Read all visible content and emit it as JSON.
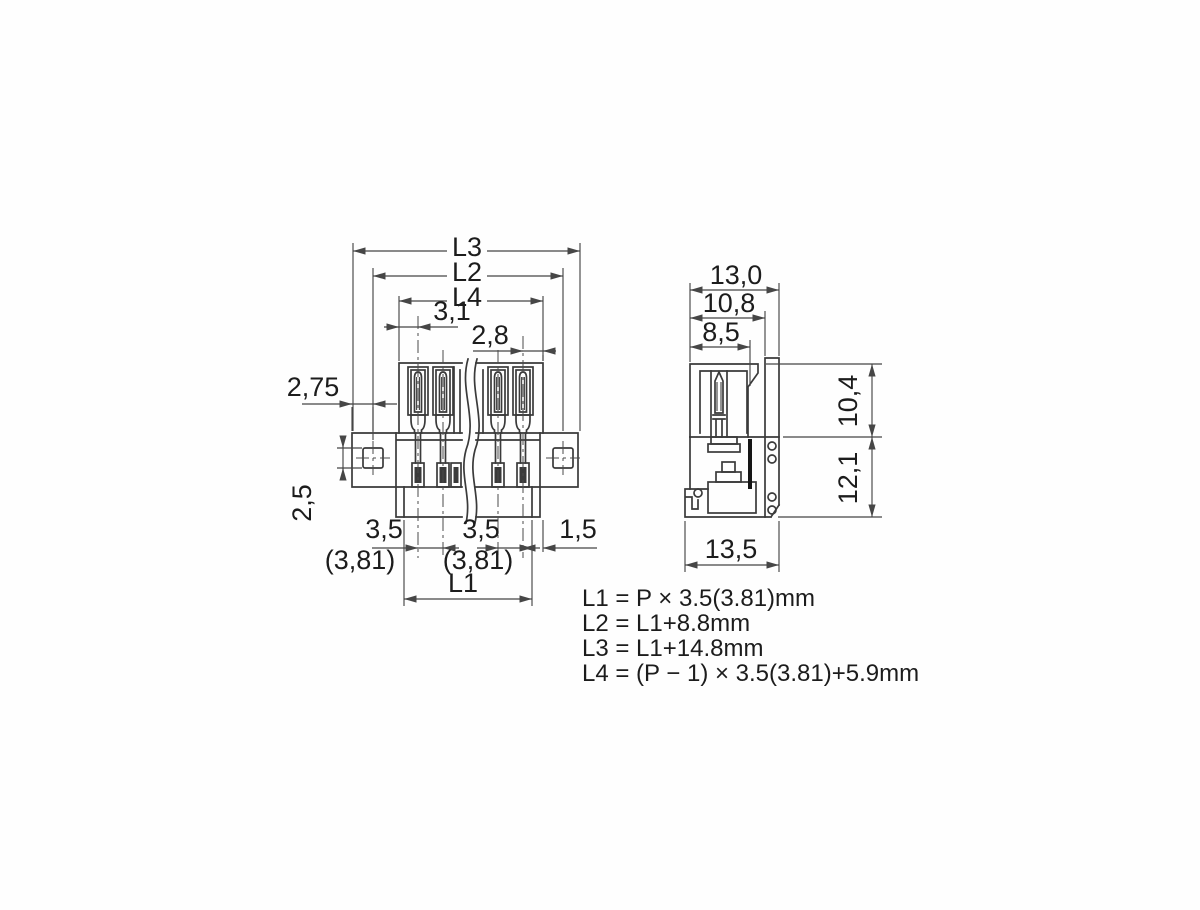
{
  "drawing": {
    "front": {
      "l3": "L3",
      "l2": "L2",
      "l4": "L4",
      "d31": "3,1",
      "d28": "2,8",
      "d275": "2,75",
      "d25": "2,5",
      "pitch_left": "3,5",
      "pitch_left_alt": "(3,81)",
      "pitch_right": "3,5",
      "pitch_right_alt": "(3,81)",
      "d15": "1,5",
      "l1": "L1"
    },
    "side": {
      "w_top": "13,0",
      "w_mid": "10,8",
      "w_inner": "8,5",
      "h_upper": "10,4",
      "h_lower": "12,1",
      "w_bottom": "13,5"
    },
    "formulas": {
      "f1": "L1 = P × 3.5(3.81)mm",
      "f2": "L2 = L1+8.8mm",
      "f3": "L3 = L1+14.8mm",
      "f4": "L4 = (P − 1) × 3.5(3.81)+5.9mm"
    },
    "colors": {
      "line": "#3a3a3a",
      "text": "#1c1c1c",
      "background": "#ffffff"
    }
  }
}
